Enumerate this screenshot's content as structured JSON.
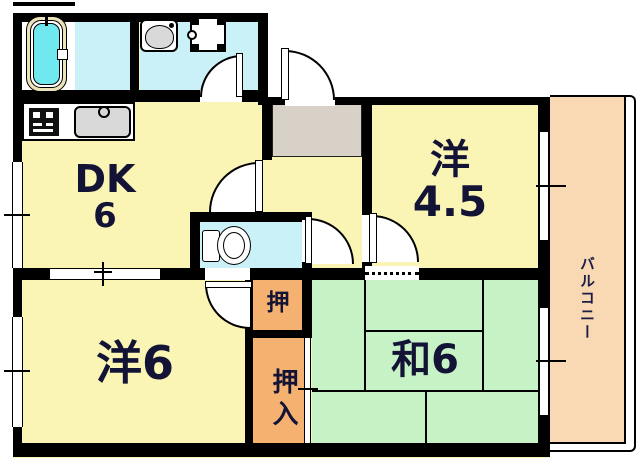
{
  "floorplan": {
    "labels": {
      "dk_line1": "DK",
      "dk_line2": "6",
      "western45_line1": "洋",
      "western45_line2": "4.5",
      "western6": "洋6",
      "japanese6": "和6",
      "closet_upper": "押",
      "closet_lower": "押入",
      "balcony": "バルコニー"
    },
    "fixtures": [
      {
        "name": "bathtub-icon"
      },
      {
        "name": "washbasin-icon"
      },
      {
        "name": "washing-machine-icon"
      },
      {
        "name": "stove-icon"
      },
      {
        "name": "kitchen-sink-icon"
      },
      {
        "name": "toilet-icon"
      }
    ],
    "doors": [
      {
        "name": "entrance-door"
      },
      {
        "name": "washroom-door"
      },
      {
        "name": "dk-door"
      },
      {
        "name": "toilet-door"
      },
      {
        "name": "western45-door"
      },
      {
        "name": "western6-door"
      }
    ],
    "colors": {
      "room_yellow": "#faf4b5",
      "wet_room_cyan": "#c9f1f7",
      "bathtub_cyan": "#70e8f0",
      "bathtub_rim_cream": "#ede3b8",
      "tatami_green": "#c7f2c6",
      "closet_orange": "#f5b170",
      "balcony_peach": "#f9d8b4",
      "genkan_gray": "#d8d1c8",
      "wall_black": "#000000",
      "label_navy": "#131335"
    }
  }
}
